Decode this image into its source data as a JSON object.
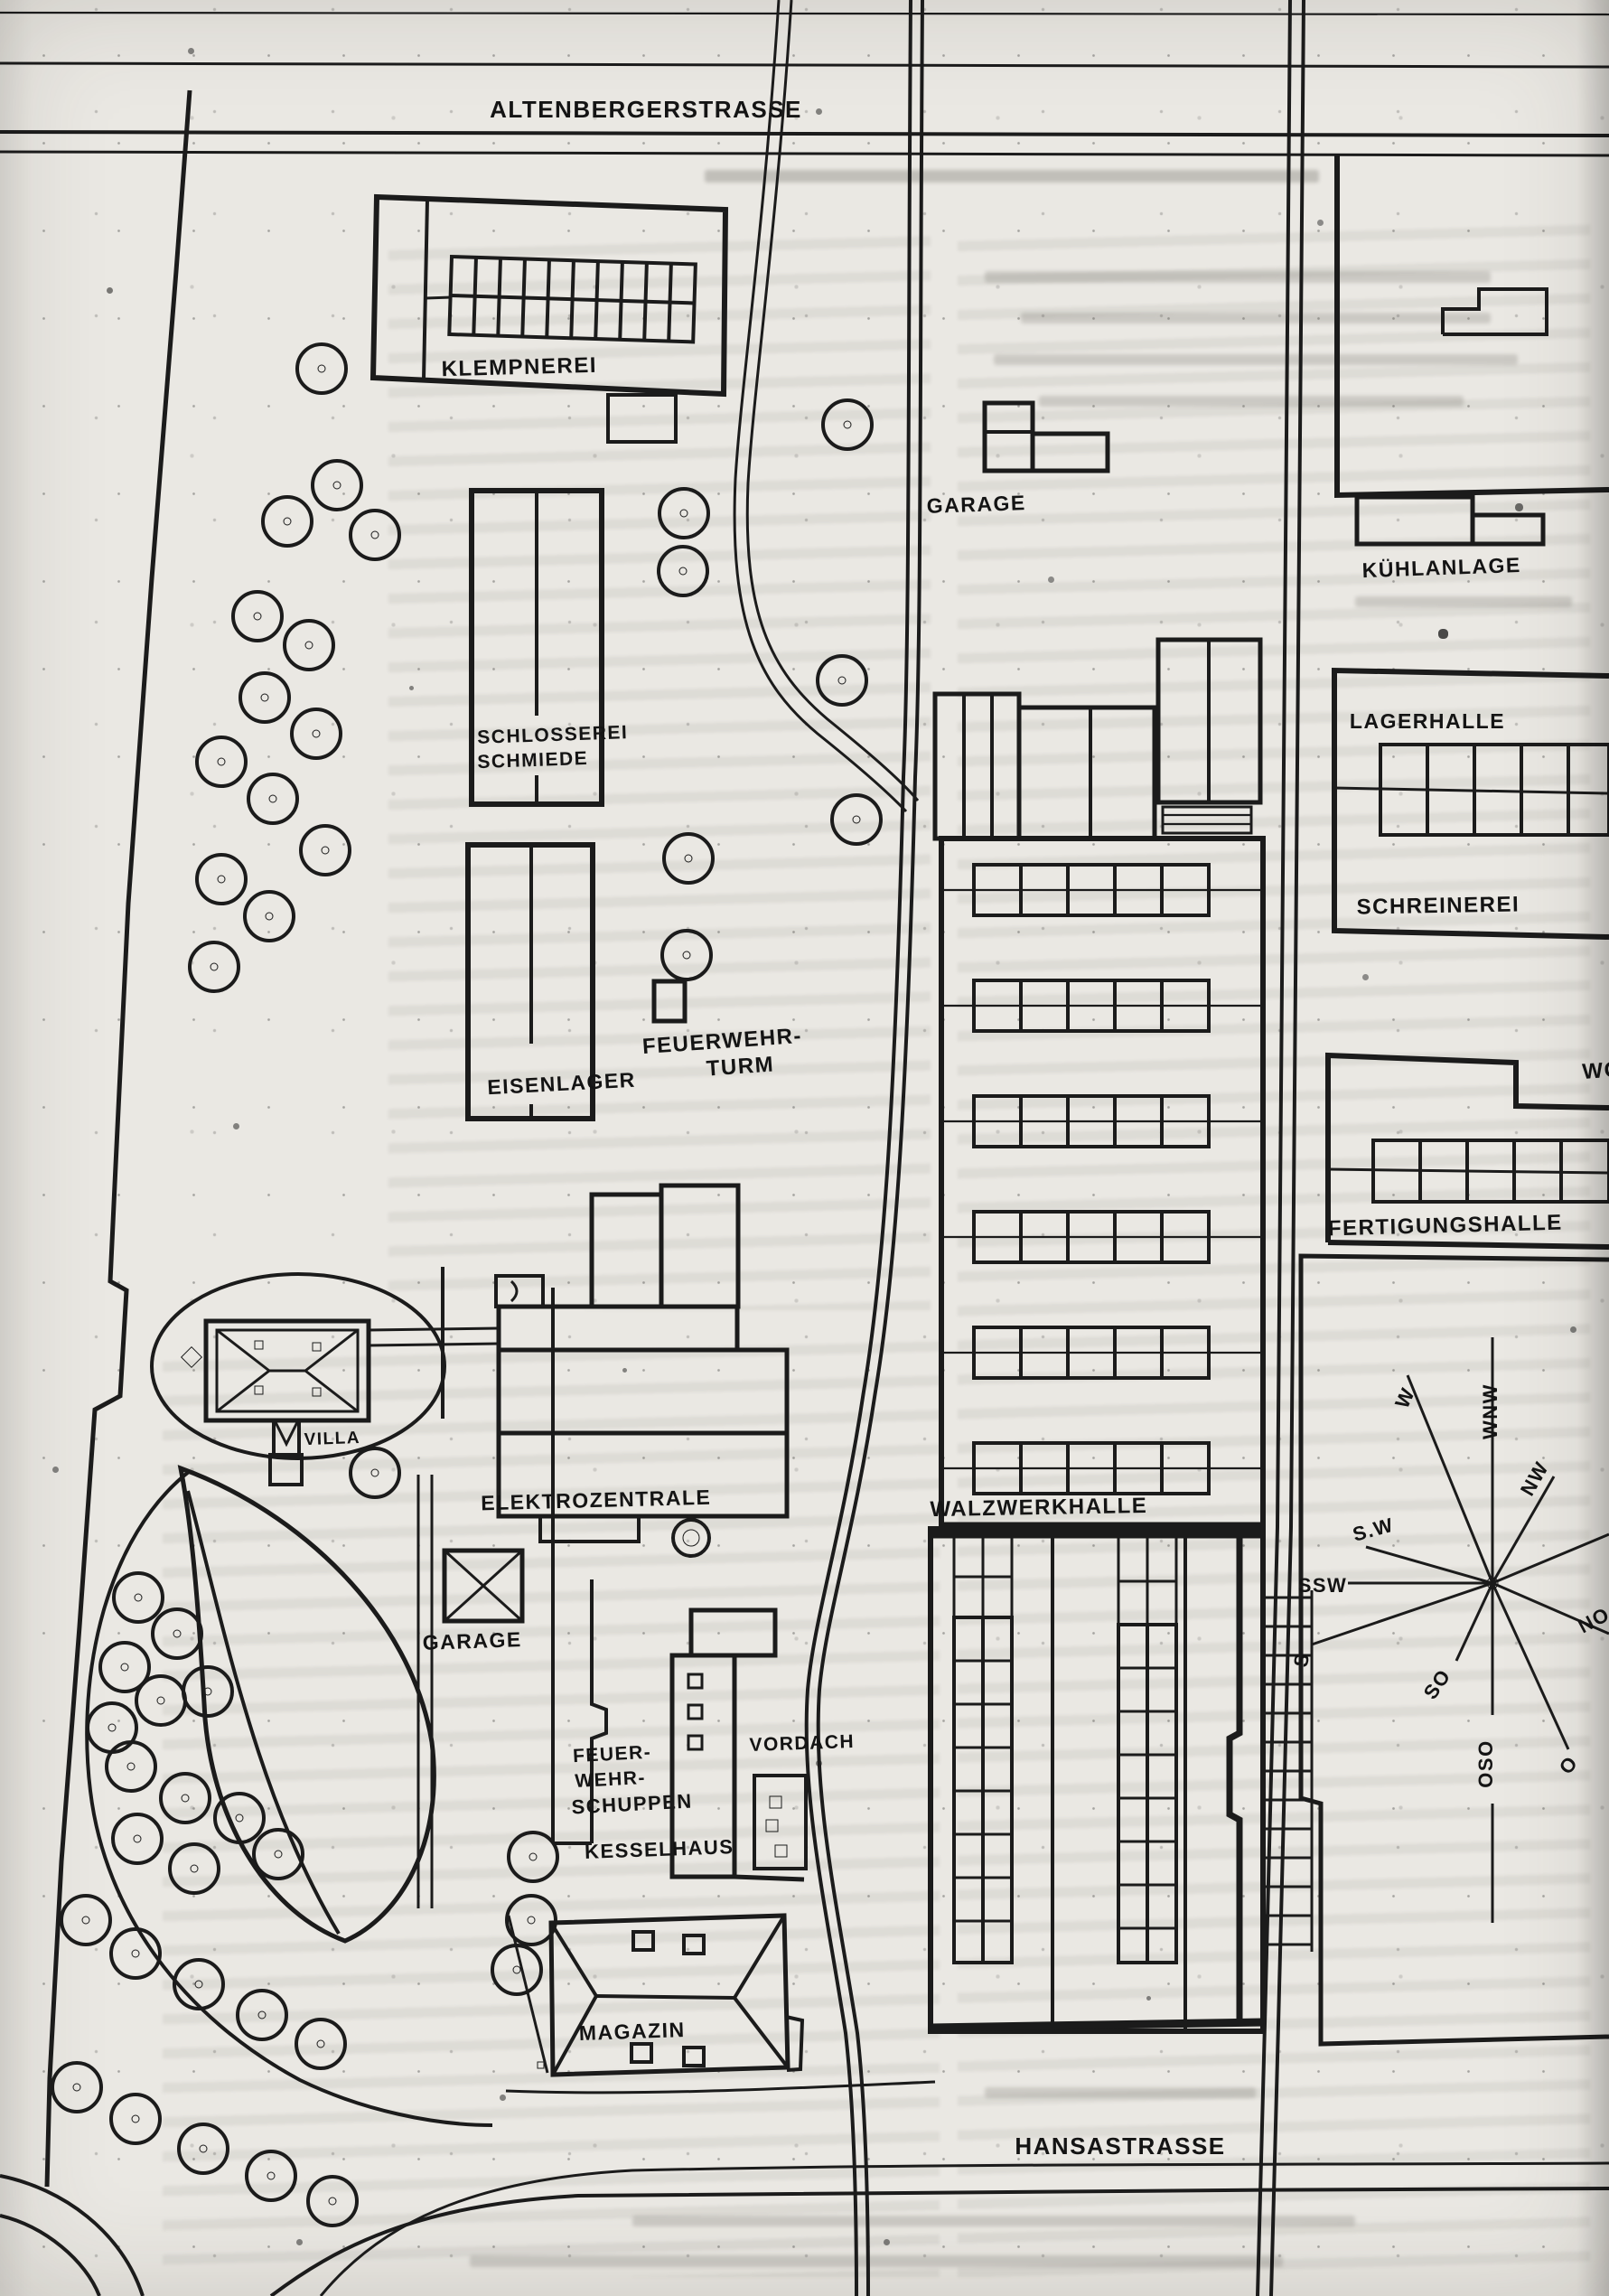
{
  "streets": {
    "top_street": "ALTENBERGERSTRASSE",
    "bottom_street": "HANSASTRASSE"
  },
  "buildings": {
    "klempnerei": "KLEMPNEREI",
    "garage_north": "GARAGE",
    "kuehlanlage": "KÜHLANLAGE",
    "lagerhalle": "LAGERHALLE",
    "schreinerei": "SCHREINEREI",
    "schlosserei_line1": "SCHLOSSEREI",
    "schlosserei_line2": "SCHMIEDE",
    "eisenlager": "EISENLAGER",
    "feuerwehrturm_line1": "FEUERWEHR-",
    "feuerwehrturm_line2": "TURM",
    "fertigungshalle": "FERTIGUNGSHALLE",
    "wohnhaus_fragment": "WO",
    "villa": "VILLA",
    "elektrozentrale": "ELEKTROZENTRALE",
    "walzwerkhalle": "WALZWERKHALLE",
    "garage_south": "GARAGE",
    "vordach": "VORDACH",
    "feuerwehrschuppen_line1": "FEUER-",
    "feuerwehrschuppen_line2": "WEHR-",
    "feuerwehrschuppen_line3": "SCHUPPEN",
    "kesselhaus": "KESSELHAUS",
    "magazin": "MAGAZIN"
  },
  "compass": {
    "w": "W",
    "wnw": "WNW",
    "nw": "NW",
    "no": "NO",
    "o": "O",
    "oso": "OSO",
    "so": "SO",
    "s": "S",
    "ssw": "SSW",
    "sw": "S.W"
  }
}
